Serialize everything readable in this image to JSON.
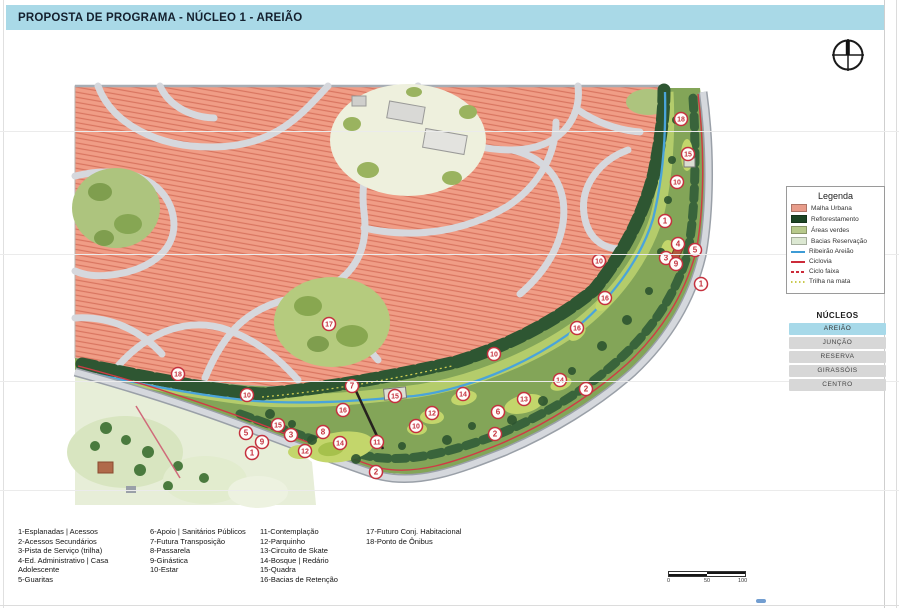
{
  "title": "PROPOSTA DE PROGRAMA - NÚCLEO 1 - AREIÃO",
  "compass": {
    "icon": "compass-north-icon"
  },
  "legend": {
    "title": "Legenda",
    "items": [
      {
        "label": "Malha Urbana",
        "type": "fill",
        "color": "#e89c8a"
      },
      {
        "label": "Reflorestamento",
        "type": "fill",
        "color": "#1c4424"
      },
      {
        "label": "Áreas verdes",
        "type": "fill",
        "color": "#b7c98b"
      },
      {
        "label": "Bacias Reservação",
        "type": "fill",
        "color": "#dce8d2"
      },
      {
        "label": "Ribeirão Areião",
        "type": "line",
        "color": "#3d9bd5"
      },
      {
        "label": "Ciclovia",
        "type": "line",
        "color": "#cc2b3a"
      },
      {
        "label": "Ciclo faixa",
        "type": "dashed",
        "color": "#cc2b3a"
      },
      {
        "label": "Trilha na mata",
        "type": "dotted",
        "color": "#c9c94e"
      }
    ]
  },
  "nucleos": {
    "title": "NÚCLEOS",
    "items": [
      {
        "label": "AREIÃO",
        "active": true
      },
      {
        "label": "JUNÇÃO",
        "active": false
      },
      {
        "label": "RESERVA",
        "active": false
      },
      {
        "label": "GIRASSÓIS",
        "active": false
      },
      {
        "label": "CENTRO",
        "active": false
      }
    ]
  },
  "program": {
    "columns": [
      {
        "items": [
          "1-Esplanadas | Acessos",
          "2-Acessos Secundários",
          "3-Pista de Serviço (trilha)",
          "4-Ed. Administrativo | Casa Adolescente",
          "5-Guaritas"
        ]
      },
      {
        "items": [
          "6-Apoio | Sanitários Públicos",
          "7-Futura Transposição",
          "8-Passarela",
          "9-Ginástica",
          "10-Estar"
        ]
      },
      {
        "items": [
          "11-Contemplação",
          "12-Parquinho",
          "13-Circuito de Skate",
          "14-Bosque | Redário",
          "15-Quadra",
          "16-Bacias de Retenção"
        ]
      },
      {
        "items": [
          "17-Futuro Conj. Habitacional",
          "18-Ponto de Ônibus"
        ]
      }
    ]
  },
  "scale_bar": {
    "labels": [
      "0",
      "50",
      "100"
    ]
  },
  "map": {
    "markers": [
      {
        "n": "18",
        "x": 681,
        "y": 119
      },
      {
        "n": "15",
        "x": 688,
        "y": 154
      },
      {
        "n": "10",
        "x": 677,
        "y": 182
      },
      {
        "n": "1",
        "x": 665,
        "y": 221
      },
      {
        "n": "4",
        "x": 678,
        "y": 244
      },
      {
        "n": "5",
        "x": 695,
        "y": 250
      },
      {
        "n": "3",
        "x": 666,
        "y": 258
      },
      {
        "n": "9",
        "x": 676,
        "y": 264
      },
      {
        "n": "1",
        "x": 701,
        "y": 284
      },
      {
        "n": "10",
        "x": 599,
        "y": 261
      },
      {
        "n": "16",
        "x": 605,
        "y": 298
      },
      {
        "n": "16",
        "x": 577,
        "y": 328
      },
      {
        "n": "17",
        "x": 329,
        "y": 324
      },
      {
        "n": "10",
        "x": 494,
        "y": 354
      },
      {
        "n": "2",
        "x": 586,
        "y": 389
      },
      {
        "n": "14",
        "x": 560,
        "y": 380
      },
      {
        "n": "13",
        "x": 524,
        "y": 399
      },
      {
        "n": "6",
        "x": 498,
        "y": 412
      },
      {
        "n": "2",
        "x": 495,
        "y": 434
      },
      {
        "n": "12",
        "x": 432,
        "y": 413
      },
      {
        "n": "14",
        "x": 463,
        "y": 394
      },
      {
        "n": "10",
        "x": 416,
        "y": 426
      },
      {
        "n": "15",
        "x": 395,
        "y": 396
      },
      {
        "n": "7",
        "x": 352,
        "y": 386
      },
      {
        "n": "16",
        "x": 343,
        "y": 410
      },
      {
        "n": "11",
        "x": 377,
        "y": 442
      },
      {
        "n": "14",
        "x": 340,
        "y": 443
      },
      {
        "n": "8",
        "x": 323,
        "y": 432
      },
      {
        "n": "12",
        "x": 305,
        "y": 451
      },
      {
        "n": "3",
        "x": 291,
        "y": 435
      },
      {
        "n": "15",
        "x": 278,
        "y": 425
      },
      {
        "n": "9",
        "x": 262,
        "y": 442
      },
      {
        "n": "5",
        "x": 246,
        "y": 433
      },
      {
        "n": "1",
        "x": 252,
        "y": 453
      },
      {
        "n": "2",
        "x": 376,
        "y": 472
      },
      {
        "n": "10",
        "x": 247,
        "y": 395
      },
      {
        "n": "18",
        "x": 178,
        "y": 374
      }
    ]
  },
  "colors": {
    "title_bar": "#a9d9e7",
    "marker": "#c5313e",
    "urban": "#f09d86",
    "reforest": "#2e5632",
    "water": "#4aa4da",
    "ciclovia": "#d03a45",
    "active_nucleo": "#a7d9e9"
  }
}
